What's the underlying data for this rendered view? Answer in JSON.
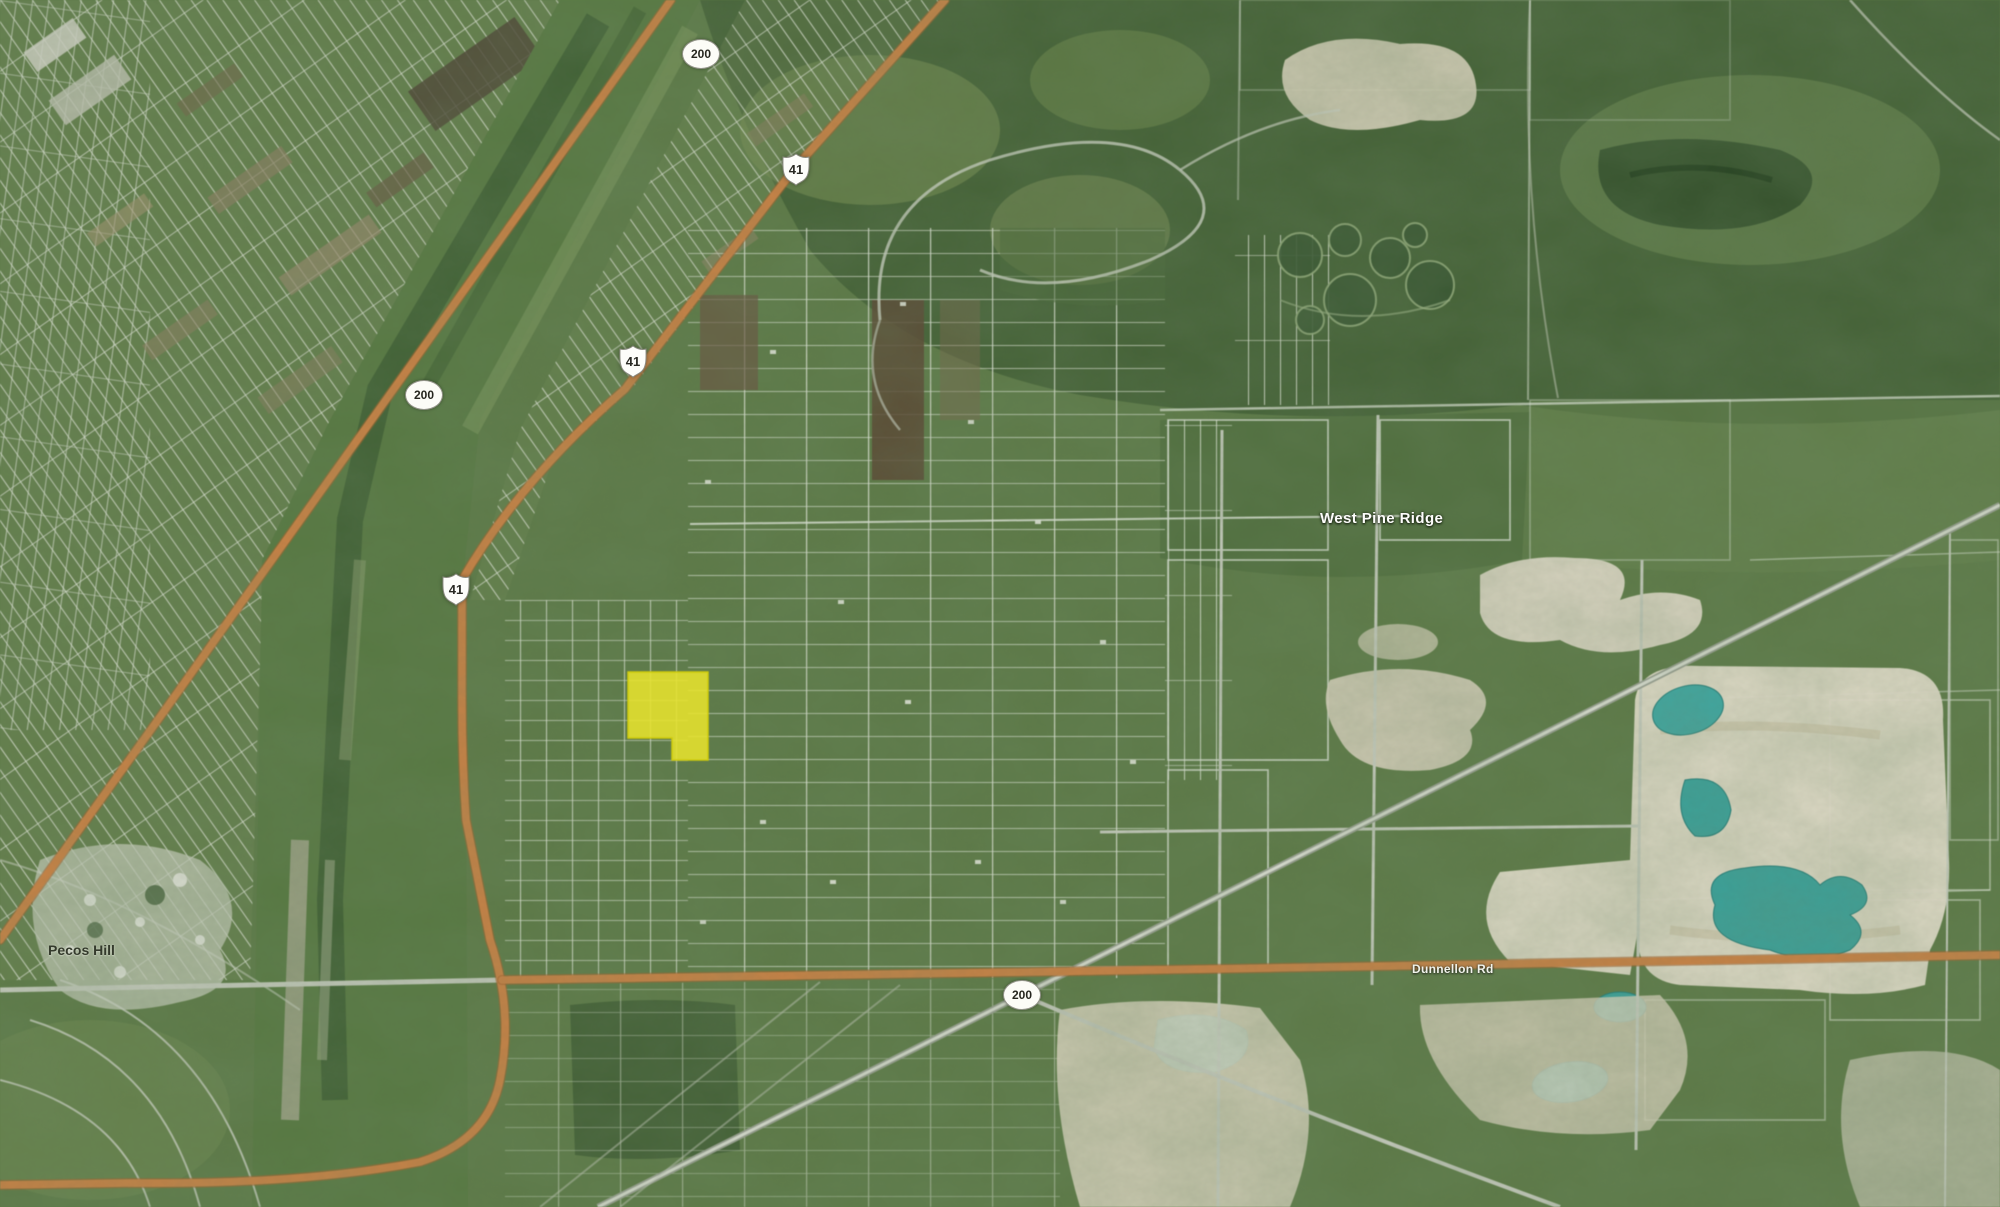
{
  "map": {
    "place_labels": {
      "west_pine_ridge": "West Pine Ridge",
      "pecos_hill": "Pecos Hill"
    },
    "road_labels": {
      "dunnellon": "Dunnellon Rd"
    },
    "shields": [
      {
        "type": "circle",
        "number": "200"
      },
      {
        "type": "us",
        "number": "41"
      },
      {
        "type": "us",
        "number": "41"
      },
      {
        "type": "circle",
        "number": "200"
      },
      {
        "type": "us",
        "number": "41"
      },
      {
        "type": "circle",
        "number": "200"
      }
    ],
    "highlight": {
      "name": "highlighted-parcel",
      "color": "#e8e424"
    },
    "colors": {
      "highway_orange": "#cf8140",
      "road_gray": "#c6cbbd",
      "pond_teal": "#35a39c",
      "quarry_sand": "#e0dac8",
      "terrain_green": "#5c7b45"
    }
  }
}
